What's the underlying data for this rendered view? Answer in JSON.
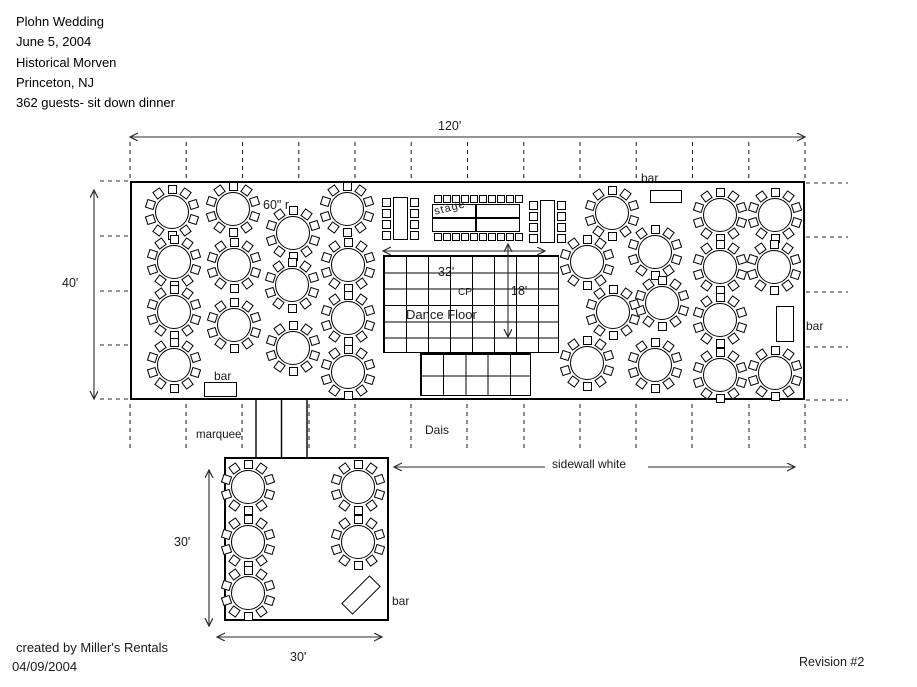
{
  "header": {
    "lines": [
      "Plohn Wedding",
      "June 5, 2004",
      "Historical Morven",
      "Princeton, NJ",
      "362 guests- sit down dinner"
    ]
  },
  "footer": {
    "created_by": "created by Miller's Rentals",
    "date": "04/09/2004",
    "revision": "Revision #2"
  },
  "dimensions": {
    "tent_width": "120'",
    "tent_depth": "40'",
    "dance_floor_width": "32'",
    "dance_floor_depth": "18'",
    "lower_tent_depth": "30'",
    "lower_tent_width": "30'",
    "round_table_size": "60\" r"
  },
  "labels": {
    "stage": "stage",
    "dance_floor": "Dance Floor",
    "center_pole": "CP'",
    "dais": "Dais",
    "marquee": "marquee",
    "sidewall": "sidewall white",
    "bar_top": "bar",
    "bar_left": "bar",
    "bar_right": "bar",
    "bar_lower": "bar"
  },
  "colors": {
    "background": "#ffffff",
    "ink": "#000000",
    "dimension_line": "#2b2b2b"
  },
  "plan": {
    "main_tent": {
      "x": 130,
      "y": 181,
      "w": 675,
      "h": 219
    },
    "lower_tent": {
      "x": 224,
      "y": 457,
      "w": 165,
      "h": 164
    },
    "corridor": {
      "left": 256,
      "right": 307,
      "mid": 281.5,
      "top": 400,
      "bottom": 457
    },
    "dance_floor": {
      "x": 383,
      "y": 255,
      "w": 176,
      "h": 98,
      "cols": 8,
      "rows": 6
    },
    "dais": {
      "x": 420,
      "y": 353,
      "w": 111,
      "h": 43,
      "cols": 5,
      "rows": 2
    },
    "round_table": {
      "diameter": 34,
      "chairs": 10,
      "chair_radius": 23
    },
    "round_tables": [
      [
        172,
        212
      ],
      [
        233,
        209
      ],
      [
        293,
        233
      ],
      [
        347,
        209
      ],
      [
        174,
        262
      ],
      [
        234,
        265
      ],
      [
        292,
        285
      ],
      [
        348,
        265
      ],
      [
        174,
        312
      ],
      [
        234,
        325
      ],
      [
        293,
        348
      ],
      [
        348,
        318
      ],
      [
        174,
        365
      ],
      [
        348,
        372
      ],
      [
        612,
        213
      ],
      [
        655,
        252
      ],
      [
        587,
        262
      ],
      [
        662,
        303
      ],
      [
        613,
        312
      ],
      [
        587,
        363
      ],
      [
        655,
        365
      ],
      [
        720,
        215
      ],
      [
        775,
        215
      ],
      [
        720,
        267
      ],
      [
        774,
        267
      ],
      [
        720,
        320
      ],
      [
        720,
        375
      ],
      [
        775,
        373
      ],
      [
        248,
        487
      ],
      [
        358,
        487
      ],
      [
        248,
        542
      ],
      [
        358,
        542
      ],
      [
        248,
        593
      ]
    ],
    "head_tables": [
      {
        "x": 393,
        "y": 197,
        "w": 15,
        "h": 43,
        "chairs_per_side": 4
      },
      {
        "x": 540,
        "y": 200,
        "w": 15,
        "h": 43,
        "chairs_per_side": 4
      }
    ],
    "stage_tables": [
      {
        "x": 432,
        "y": 204,
        "w": 44,
        "h": 14
      },
      {
        "x": 476,
        "y": 204,
        "w": 44,
        "h": 14
      },
      {
        "x": 432,
        "y": 218,
        "w": 44,
        "h": 14
      },
      {
        "x": 476,
        "y": 218,
        "w": 44,
        "h": 14
      }
    ],
    "stage_chairs": {
      "x_start": 434,
      "step": 9,
      "count": 10,
      "top_y": 195,
      "bottom_y": 233,
      "size": 8
    },
    "bars": {
      "top": {
        "x": 650,
        "y": 190,
        "w": 32,
        "h": 13
      },
      "left": {
        "x": 204,
        "y": 382,
        "w": 33,
        "h": 15
      },
      "right": {
        "x": 776,
        "y": 306,
        "w": 18,
        "h": 36
      },
      "lower": {
        "x": 341,
        "y": 587,
        "w": 40,
        "h": 16,
        "rot": -45
      }
    },
    "arrows": [
      {
        "x1": 130,
        "y1": 137,
        "x2": 805,
        "y2": 137,
        "both": true
      },
      {
        "x1": 94,
        "y1": 190,
        "x2": 94,
        "y2": 399,
        "both": true
      },
      {
        "x1": 383,
        "y1": 251,
        "x2": 545,
        "y2": 251,
        "both": true
      },
      {
        "x1": 508,
        "y1": 244,
        "x2": 508,
        "y2": 337,
        "both": true
      },
      {
        "x1": 545,
        "y1": 467,
        "x2": 394,
        "y2": 467,
        "both": false
      },
      {
        "x1": 648,
        "y1": 467,
        "x2": 795,
        "y2": 467,
        "both": false
      },
      {
        "x1": 209,
        "y1": 470,
        "x2": 209,
        "y2": 626,
        "both": true
      },
      {
        "x1": 217,
        "y1": 637,
        "x2": 382,
        "y2": 637,
        "both": true
      }
    ],
    "dashed": {
      "top_ticks": {
        "x0": 130,
        "step": 56.25,
        "n": 13,
        "y1": 142,
        "y2": 180
      },
      "bottom_ticks": {
        "xs": [
          130,
          186,
          242,
          309,
          355,
          411,
          467,
          524,
          580,
          636,
          692,
          749,
          805
        ],
        "y1": 404,
        "y2": 451
      },
      "left_ticks": {
        "ys": [
          181,
          236,
          291,
          345,
          399
        ],
        "x1": 100,
        "x2": 129
      },
      "right_ticks": {
        "ys": [
          183,
          237,
          292,
          347,
          400
        ],
        "x1": 806,
        "x2": 848
      }
    }
  }
}
